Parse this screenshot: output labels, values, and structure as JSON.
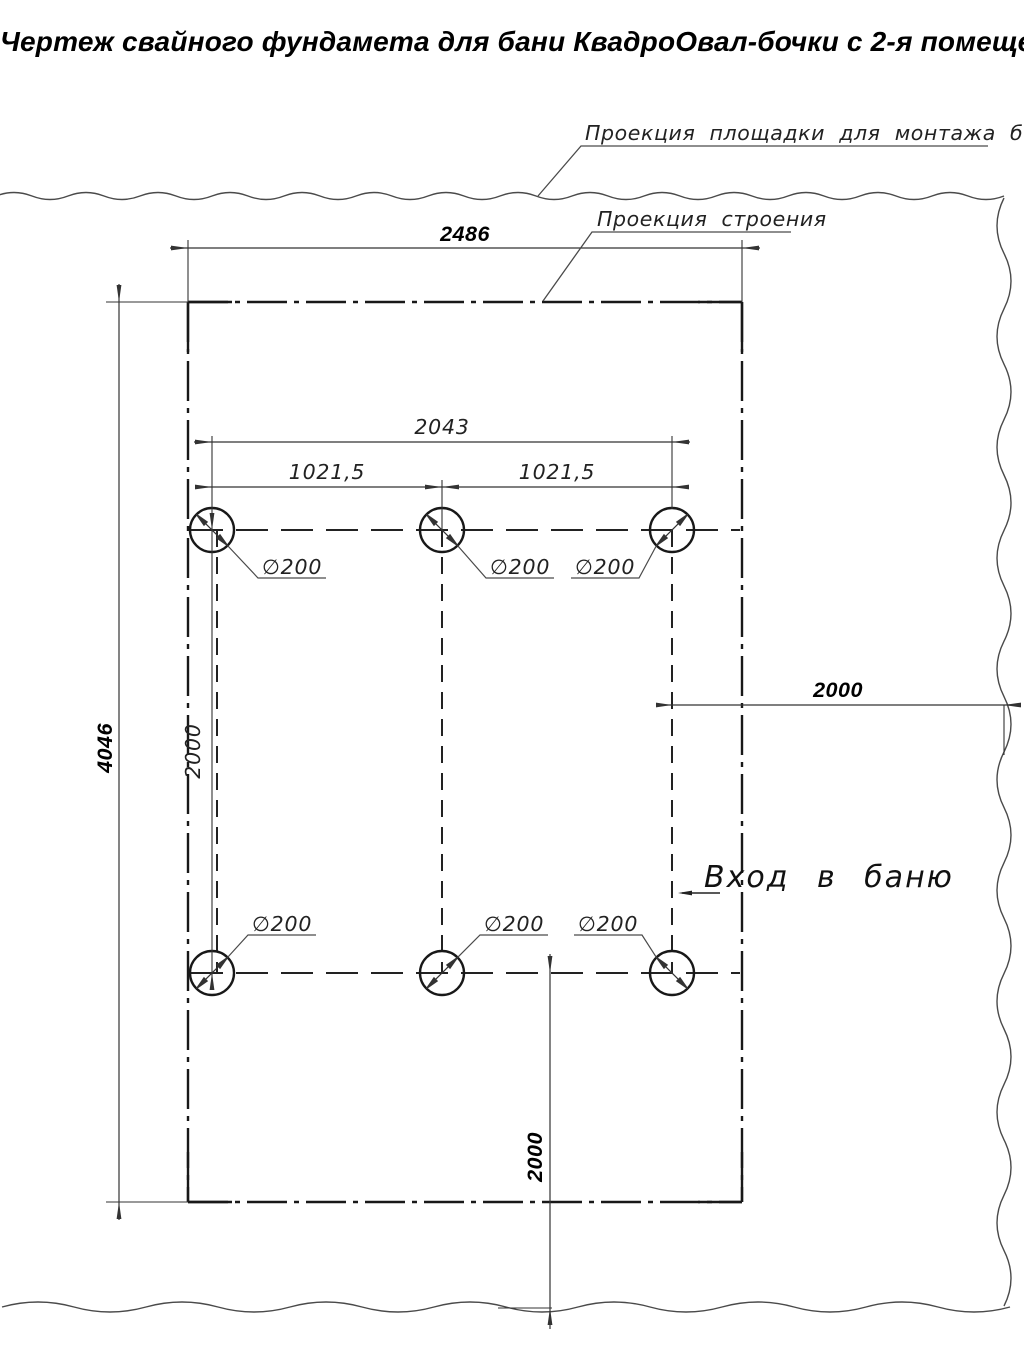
{
  "title": "Чертеж свайного фундамета для бани КвадроОвал-бочки с 2-я помещениями",
  "callouts": {
    "site_projection": "Проекция площадки для монтажа бани",
    "building_projection": "Проекция строения",
    "entrance": "Вход в баню"
  },
  "dimensions": {
    "building_width": "2486",
    "building_length": "4046",
    "pile_span_total": "2043",
    "pile_span_left": "1021,5",
    "pile_span_right": "1021,5",
    "pile_row_spacing": "2000",
    "entrance_clearance": "2000",
    "bottom_clearance": "2000",
    "pile_diameter_label": "∅200"
  },
  "colors": {
    "line_main": "#181818",
    "line_thin": "#333333",
    "line_wavy": "#4a4a4a"
  }
}
